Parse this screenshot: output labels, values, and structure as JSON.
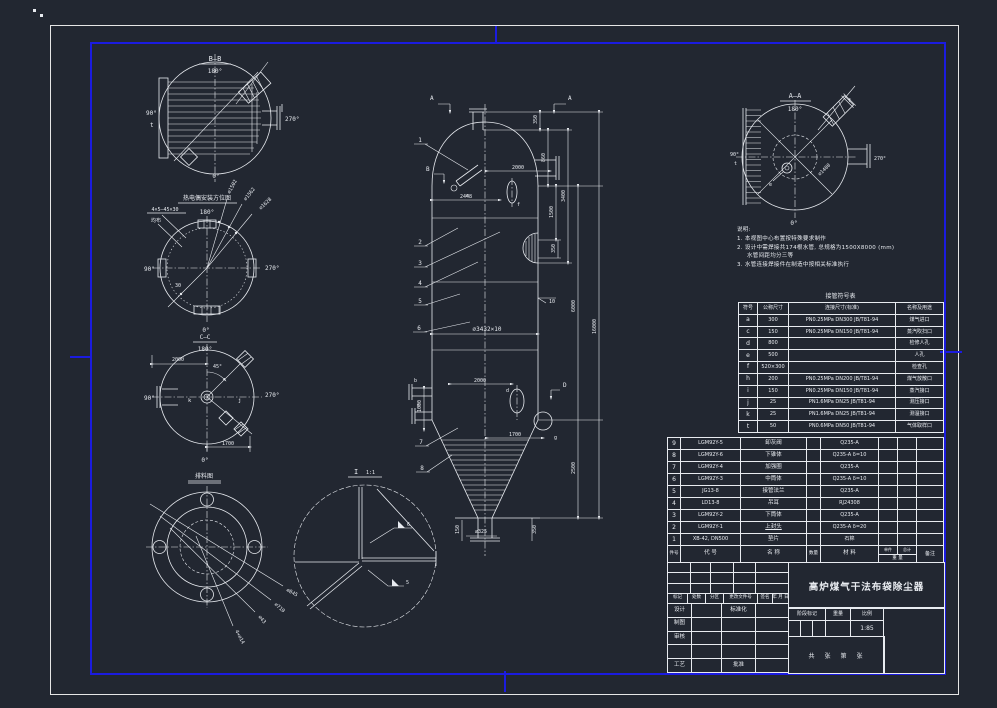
{
  "views": {
    "bb": {
      "title": "B—B",
      "deg180": "180°",
      "deg90": "90°",
      "t": "t",
      "deg270": "270°",
      "deg0": "0°"
    },
    "orient": {
      "title": "热电偶安装方位图",
      "deg180": "180°",
      "deg90": "90°",
      "deg270": "270°",
      "deg0": "0°",
      "note1": "4×5—45×30",
      "note2": "均布",
      "d1": "∅1502",
      "d2": "∅1562",
      "d3": "∅1628",
      "a30": "30"
    },
    "cc": {
      "title": "C—C",
      "sub": "180°",
      "deg90": "90°",
      "deg270": "270°",
      "deg0": "0°",
      "d2000": "2000",
      "a45": "45°",
      "d1700": "1700",
      "k": "k",
      "j": "j"
    },
    "flange": {
      "title": "排料图",
      "d1": "∅845",
      "d2": "∅710",
      "d3": "∅43",
      "d4": "4×∅14"
    },
    "detail": {
      "title": "I",
      "scale": "1:1",
      "w1": "6",
      "w2": "5"
    },
    "aa": {
      "title": "A—A",
      "deg180": "180°",
      "deg90": "90°",
      "t": "t",
      "deg270": "270°",
      "deg0": "0°",
      "d1": "∅1400",
      "f": "f",
      "e": "e"
    }
  },
  "vessel": {
    "secA": "A",
    "secB": "B",
    "secD": "D",
    "balloons": [
      "1",
      "2",
      "3",
      "4",
      "5",
      "6",
      "7",
      "8"
    ],
    "letters": {
      "b": "b",
      "c": "c",
      "d": "d",
      "e": "e",
      "f": "f",
      "g": "g"
    },
    "dims": {
      "d350t": "350",
      "d860": "860",
      "d1500": "1500",
      "d350m": "350",
      "d3400": "3400",
      "d6000": "6000",
      "d2500": "2500",
      "d16000": "16000",
      "d10": "10",
      "d2448": "2448",
      "d2000t": "2000",
      "shell": "∅3432×10",
      "d2000m": "2000",
      "d1000": "1000",
      "d1700": "1700",
      "d325": "∅325",
      "d150": "150",
      "d350b": "350"
    }
  },
  "notes": {
    "title": "说明:",
    "l1": "1. 本视图中心布置按特殊要求制作",
    "l2": "2. 设计中需焊接共174根水管, 总规格为1500X8000 (mm)",
    "l2b": "水管间距均分三等",
    "l3": "3. 水管连接焊接件在制造中按相关标准执行"
  },
  "nozzle_table": {
    "title": "接管符号表",
    "headers": [
      "符号",
      "公称尺寸",
      "连接尺寸(标准)",
      "名称及用途"
    ],
    "rows": [
      [
        "a",
        "300",
        "PN0.25MPa DN300 JB/T81-94",
        "煤气进口"
      ],
      [
        "c",
        "150",
        "PN0.25MPa DN150 JB/T81-94",
        "蒸汽吹扫口"
      ],
      [
        "d",
        "800",
        "",
        "检修人孔"
      ],
      [
        "e",
        "500",
        "",
        "人孔"
      ],
      [
        "f",
        "520×300",
        "",
        "检查孔"
      ],
      [
        "h",
        "200",
        "PN0.25MPa DN200 JB/T81-94",
        "煤气放散口"
      ],
      [
        "i",
        "150",
        "PN0.25MPa DN150 JB/T81-94",
        "蒸汽接口"
      ],
      [
        "j",
        "25",
        "PN1.6MPa DN25 JB/T81-94",
        "测压接口"
      ],
      [
        "k",
        "25",
        "PN1.6MPa DN25 JB/T81-94",
        "测温接口"
      ],
      [
        "t",
        "50",
        "PN0.6MPa DN50 JB/T81-94",
        "气体取样口"
      ]
    ]
  },
  "bom": {
    "headers": {
      "no": "件号",
      "code": "代 号",
      "name": "名 称",
      "qty": "数量",
      "mat": "材 料",
      "unit": "单件",
      "total": "总计",
      "weight": "重 量",
      "remark": "备注"
    },
    "rows": [
      [
        "9",
        "LGM92Y-5",
        "卸灰阀",
        "",
        "Q235-A",
        "",
        "",
        ""
      ],
      [
        "8",
        "LGM92Y-6",
        "下锥体",
        "",
        "Q235-A δ=10",
        "",
        "",
        ""
      ],
      [
        "7",
        "LGM92Y-4",
        "加强圈",
        "",
        "Q235-A",
        "",
        "",
        ""
      ],
      [
        "6",
        "LGM92Y-3",
        "中筒体",
        "",
        "Q235-A δ=10",
        "",
        "",
        ""
      ],
      [
        "5",
        "JG13-8",
        "接管法兰",
        "",
        "Q235-A",
        "",
        "",
        ""
      ],
      [
        "4",
        "LD13-8",
        "吊耳",
        "",
        "RJ24308",
        "",
        "",
        ""
      ],
      [
        "3",
        "LGM92Y-2",
        "下筒体",
        "",
        "Q235-A",
        "",
        "",
        ""
      ],
      [
        "2",
        "LGM92Y-1",
        "上封头",
        "",
        "Q235-A δ=20",
        "",
        "",
        ""
      ],
      [
        "1",
        "XB-42, DN500",
        "垫片",
        "",
        "石棉",
        "",
        "",
        ""
      ]
    ]
  },
  "title_block": {
    "drawing_title": "高炉煤气干法布袋除尘器",
    "rev_labels": [
      "标记",
      "处数",
      "分区",
      "更改文件号",
      "签名",
      "年 月 日"
    ],
    "roles": {
      "design": "设计",
      "draft": "制图",
      "check": "审核",
      "process": "工艺",
      "standard": "标准化",
      "approve": "批准"
    },
    "stage_label": "阶段标记",
    "weight_label": "重量",
    "scale_label": "比例",
    "scale_value": "1:85",
    "sheet": "共　张　第　张"
  }
}
